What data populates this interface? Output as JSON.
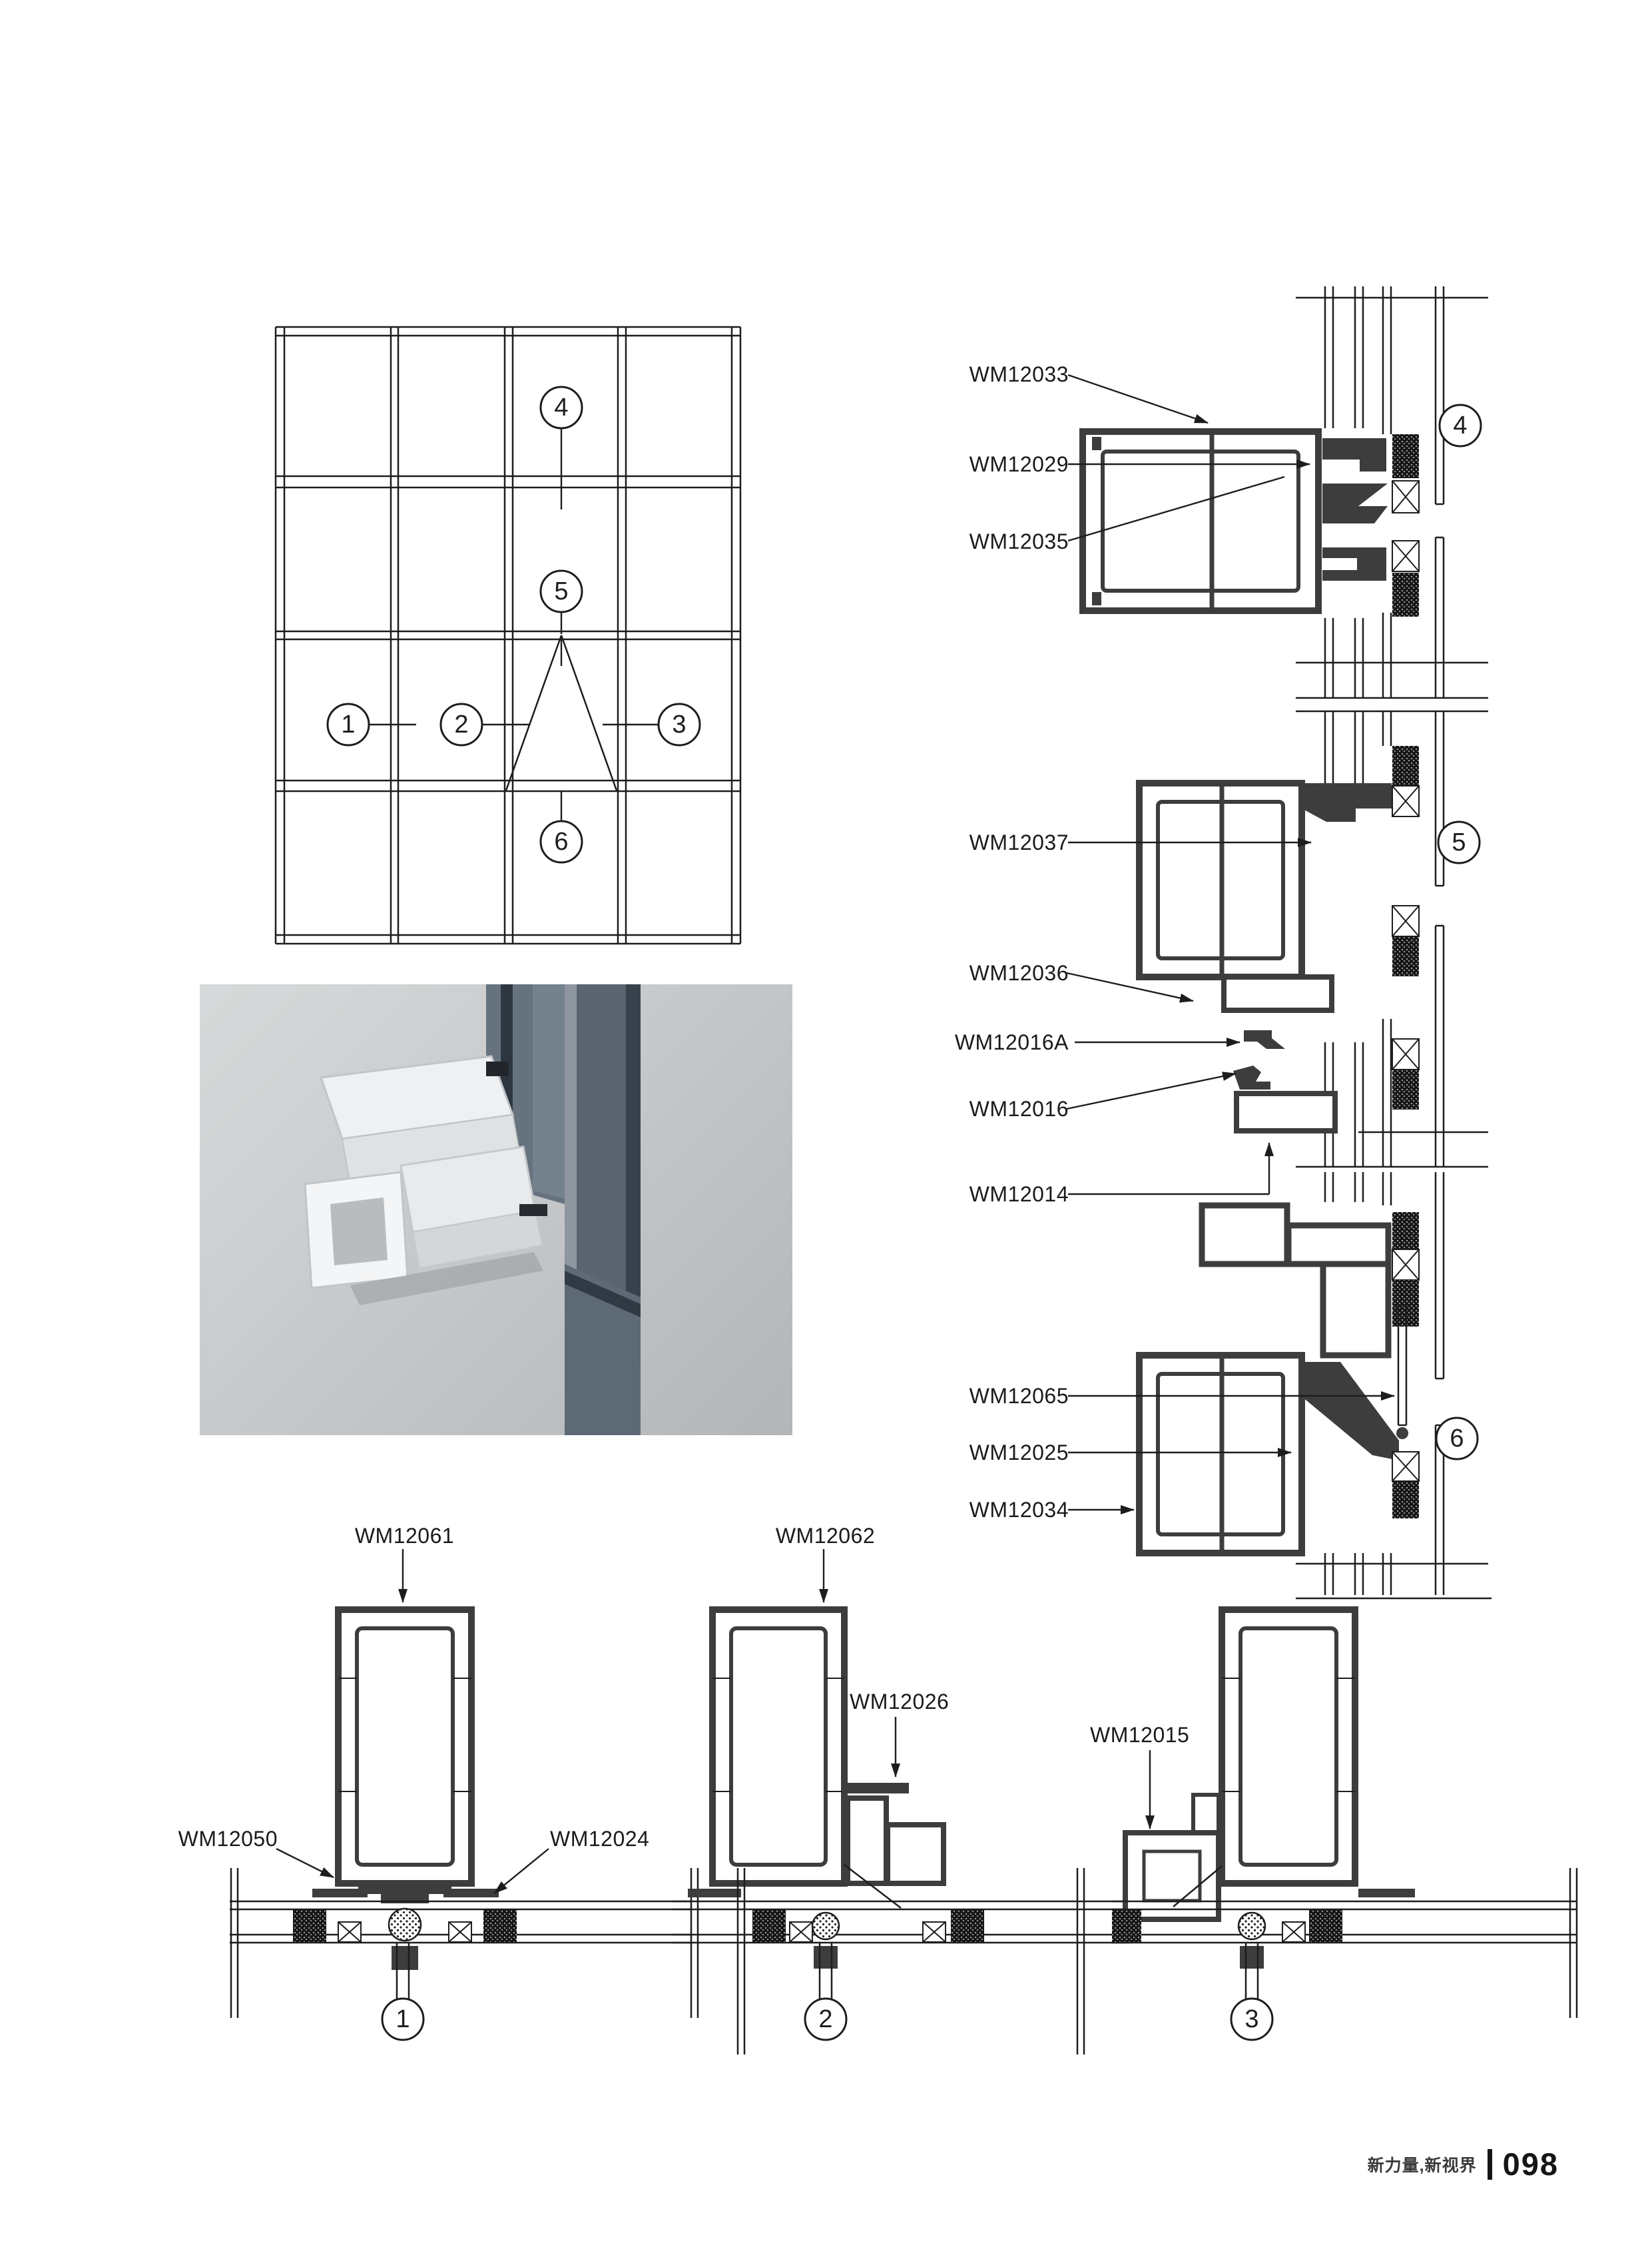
{
  "footer": {
    "tagline": "新力量,新视界",
    "page_number": "098"
  },
  "callouts": {
    "c1": "1",
    "c2": "2",
    "c3": "3",
    "c4": "4",
    "c5": "5",
    "c6": "6"
  },
  "part_labels": {
    "d4": [
      "WM12033",
      "WM12029",
      "WM12035"
    ],
    "d5": [
      "WM12037",
      "WM12036",
      "WM12016A",
      "WM12016",
      "WM12014"
    ],
    "d6": [
      "WM12065",
      "WM12025",
      "WM12034"
    ],
    "d1": [
      "WM12061",
      "WM12050",
      "WM12024"
    ],
    "d2": [
      "WM12062",
      "WM12026"
    ],
    "d3": [
      "WM12015"
    ]
  }
}
